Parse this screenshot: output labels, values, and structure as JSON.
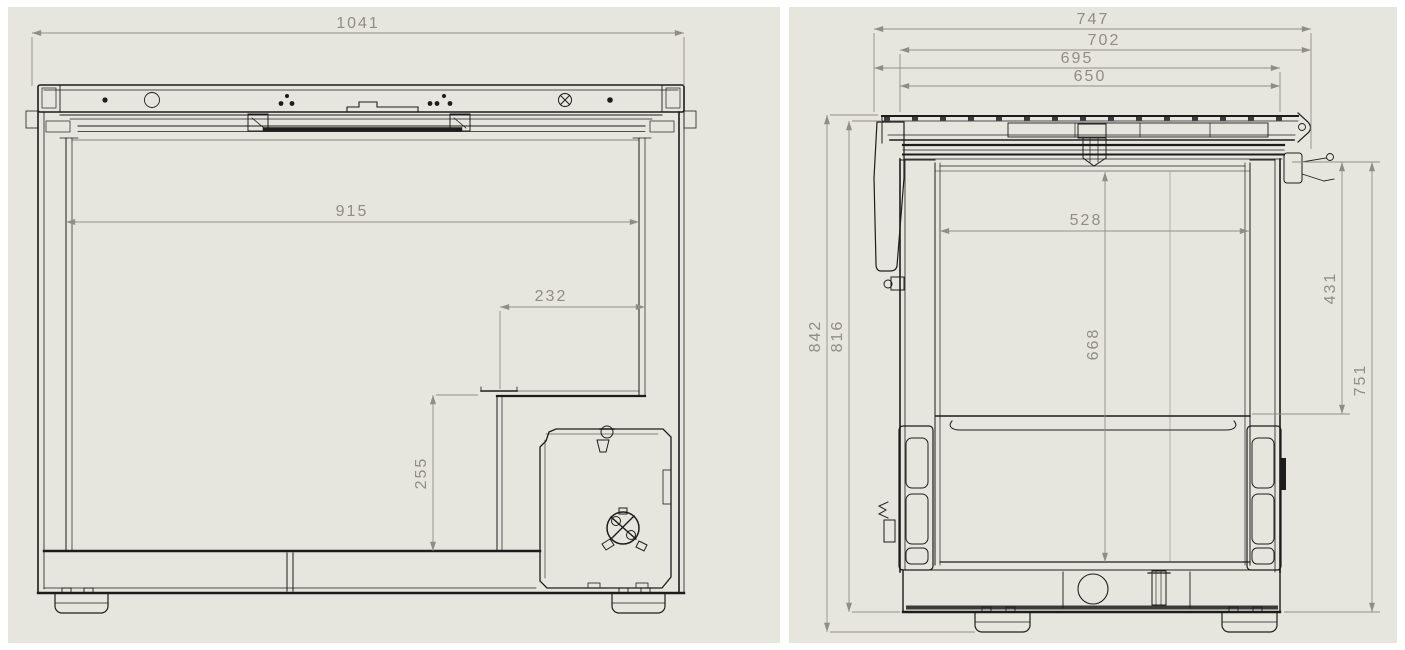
{
  "colors": {
    "page_bg": "#ffffff",
    "panel_bg": "#e7e6de",
    "line": "#1c1c1c",
    "dim_line": "#918f86",
    "dim_text": "#8f8d84"
  },
  "front_view": {
    "dims": {
      "overall_width": "1041",
      "interior_width": "915",
      "step_width": "232",
      "step_height": "255"
    }
  },
  "side_view": {
    "dims": {
      "overall_depth": "747",
      "lid_depth": "702",
      "hinge_depth": "695",
      "body_depth": "650",
      "overall_height": "842",
      "body_height": "816",
      "interior_depth": "528",
      "interior_height": "668",
      "basket_height": "431",
      "rim_height": "751"
    }
  }
}
